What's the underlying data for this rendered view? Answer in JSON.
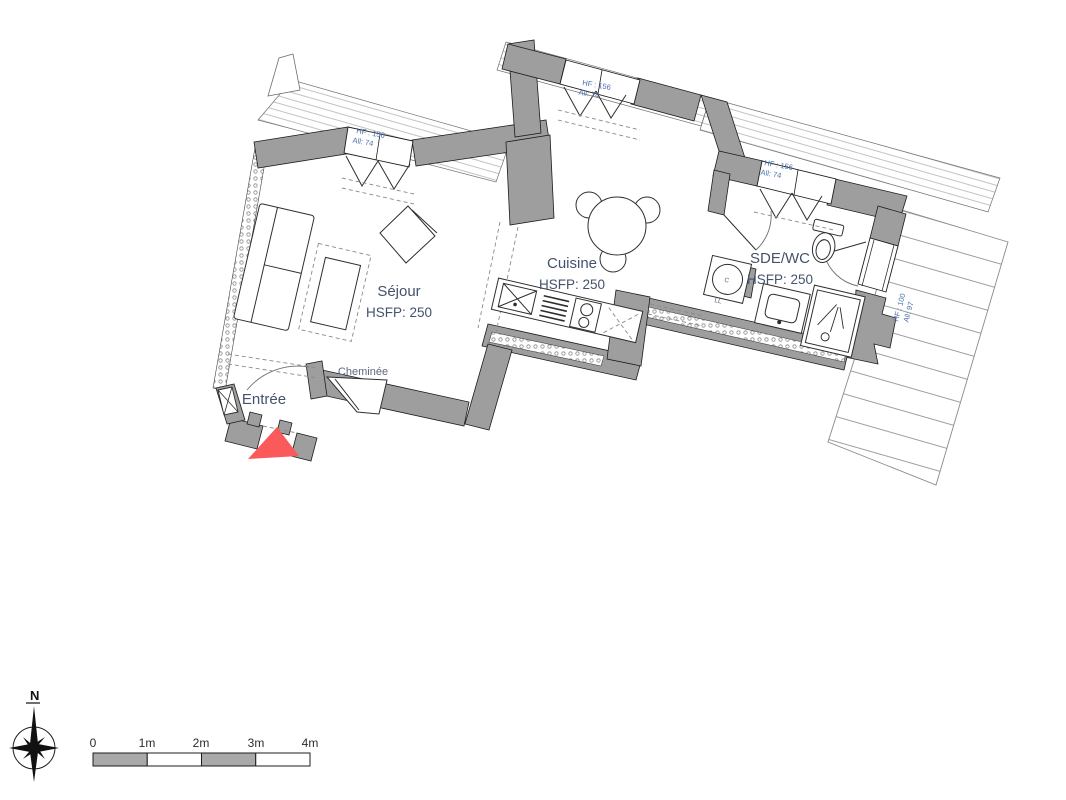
{
  "plan": {
    "rooms": [
      {
        "id": "sejour",
        "name": "Séjour",
        "hsfp": "HSFP: 250"
      },
      {
        "id": "cuisine",
        "name": "Cuisine",
        "hsfp": "HSFP: 250"
      },
      {
        "id": "sde_wc",
        "name": "SDE/WC",
        "hsfp": "HSFP: 250"
      },
      {
        "id": "entree",
        "name": "Entrée"
      }
    ],
    "annotations": {
      "cheminee": "Cheminée",
      "washer_drum": "C",
      "washer": "LL"
    },
    "windows": [
      {
        "id": "sejour-window",
        "hf": "HF : 156",
        "allege": "All: 74"
      },
      {
        "id": "cuisine-window",
        "hf": "HF : 156",
        "allege": "All: 74"
      },
      {
        "id": "sde-window",
        "hf": "HF : 156",
        "allege": "All: 74"
      },
      {
        "id": "sde-french-door",
        "hf": "HF : 100",
        "allege": "All: 97"
      }
    ],
    "colors": {
      "wall": "#9e9e9e",
      "entry_marker": "#fb5a5a",
      "label_blue": "#4a6fad",
      "label_dark": "#44536b"
    }
  },
  "legend": {
    "compass_north": "N",
    "scale_ticks": [
      "0",
      "1m",
      "2m",
      "3m",
      "4m"
    ]
  }
}
